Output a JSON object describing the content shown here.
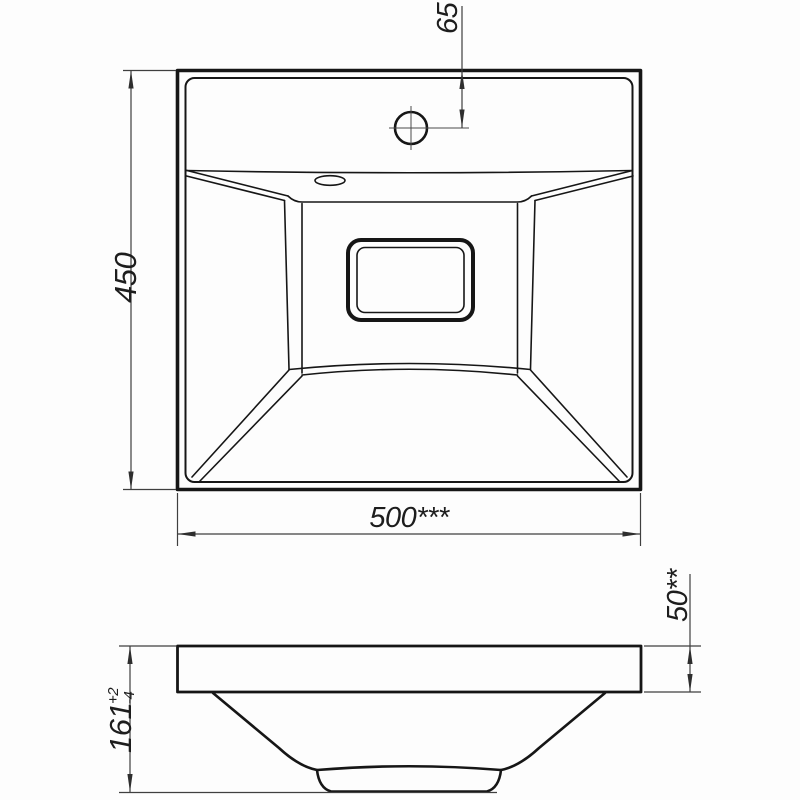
{
  "drawing": {
    "kind": "sink-dimension-drawing",
    "views": {
      "top_view": "plan view of square washbasin with faucet hole, overflow slot and drain opening",
      "side_view": "front section view of basin rim and bowl"
    }
  },
  "dimensions": {
    "basin_width": {
      "label": "500***"
    },
    "basin_depth": {
      "label": "450"
    },
    "faucet_hole_offset": {
      "label": "65"
    },
    "overall_height": {
      "label": "161",
      "tolerance_plus": "+2",
      "tolerance_minus": "-4"
    },
    "rim_height": {
      "label": "50**"
    }
  },
  "colors": {
    "background": "#fdfdfd",
    "outline": "#161616",
    "dimension_lines": "#3f3f3f",
    "text": "#1d1d1d"
  }
}
